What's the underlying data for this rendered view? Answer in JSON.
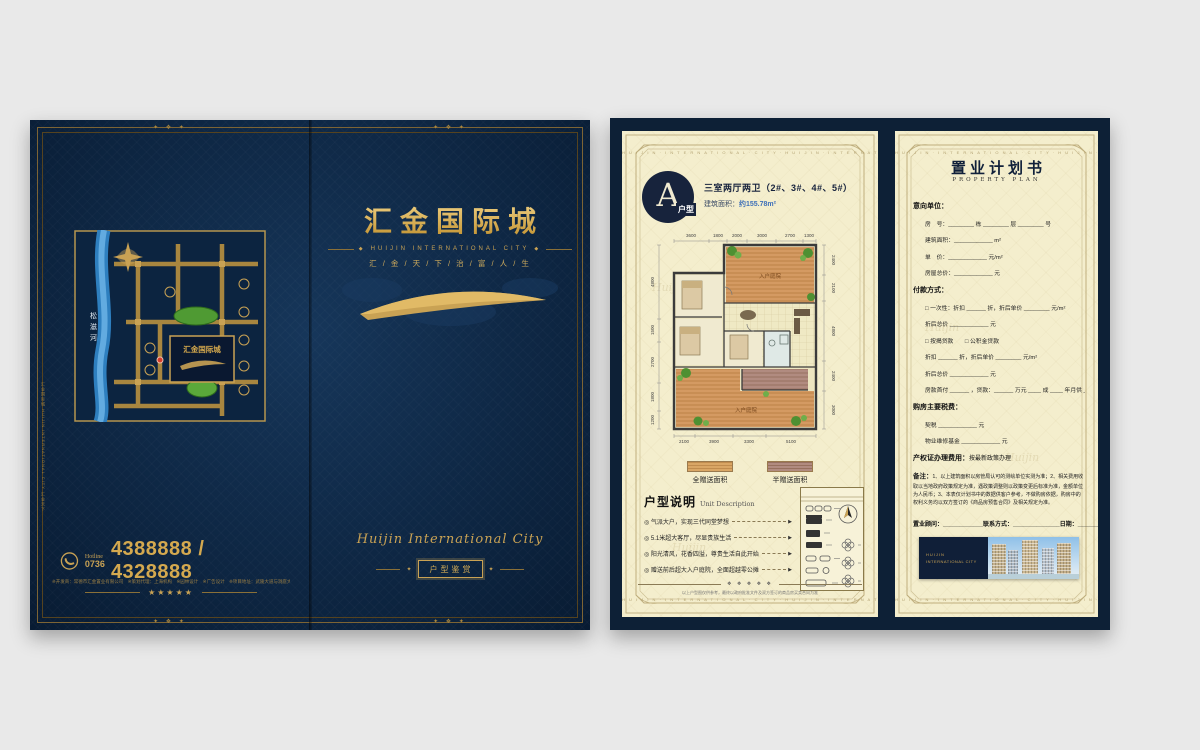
{
  "icons": {
    "diamond": "◆",
    "arrow": "▶",
    "phone": "phone-icon",
    "compass": "compass-icon"
  },
  "cover": {
    "ornament": "✦ ❖ ✦",
    "spine_text": "汇金国际城 HUIJIN INTERNATIONAL CITY 汇金天下",
    "map": {
      "river_chars": [
        "松",
        "滋",
        "河"
      ],
      "project": "汇金国际城"
    },
    "hotline_label": "Hotline",
    "hotline_code": "0736",
    "phones": "4388888 / 4328888",
    "fine_print": "※开发商：常德市汇金置业有限公司　※策划代理：上海机构　※园林设计　※广告设计　※项目地址：武陵大道与洞庭大道交汇处",
    "stars": "★★★★★",
    "title": "汇金国际城",
    "subtitle": "HUIJIN INTERNATIONAL CITY",
    "tagline": "汇 / 金 / 天 / 下 / 治 / 富 / 人 / 生",
    "script_name": "Huijin International City",
    "badge": "户型鉴赏"
  },
  "interior": {
    "border_letters": "H U I J I N · I N T E R N A T I O N A L · C I T Y · H U I J I N · I N T E R N A T I O N A L · C I T Y",
    "watermark": "Huijin",
    "unit": {
      "letter": "A",
      "type_label": "户型",
      "rooms": "三室两厅两卫（2#、3#、4#、5#）",
      "area_label": "建筑面积：",
      "area_value": "约155.78m²"
    },
    "floorplan": {
      "courtyard_top": "入户庭院",
      "courtyard_bottom": "入户庭院",
      "dims_top": [
        "3600",
        "1800",
        "2000",
        "3000",
        "2700",
        "1300"
      ],
      "dims_bottom": [
        "2100",
        "3900",
        "3300",
        "5100"
      ],
      "dims_left": [
        "4800",
        "1500",
        "2700",
        "1800",
        "1200"
      ],
      "dims_right": [
        "2400",
        "2100",
        "4800",
        "2400",
        "3000"
      ]
    },
    "legend": {
      "full": "全赠送面积",
      "half": "半赠送面积"
    },
    "unit_desc": {
      "title": "户型说明",
      "subtitle": "Unit Description",
      "items": [
        "◎ 气派大户，实现三代同堂梦想",
        "◎ 5.1米超大客厅，尽显贵族生活",
        "◎ 阳光清风，花香四溢，尊贵生活自此开始",
        "◎ 赠送前后超大入户庭院，全面超越零公摊"
      ],
      "arrow": "▶",
      "divider_glyphs": "❖ ❖ ❖ ❖ ❖",
      "disclaimer": "以上户型图仅供参考，最终以政府批准文件及双方签订的商品房买卖合同为准"
    }
  },
  "form": {
    "title": "置业计划书",
    "subtitle": "PROPERTY PLAN",
    "intent": {
      "label": "意向单位：",
      "lines": [
        "房　号：________ 栋 ________ 层 ________ 号",
        "建筑面积：____________ m²",
        "单　价：____________ 元/m²",
        "房屋总价：____________ 元"
      ]
    },
    "payment": {
      "label": "付款方式：",
      "lines": [
        "□ 一次性：折扣 ______ 折，折后单价 ________ 元/m²",
        "折后总价 ____________ 元",
        "□ 按揭贷款　　□ 公积金贷款",
        "折扣 ______ 折，折后单价 ________ 元/m²",
        "折后总价 ____________ 元",
        "房款首付 ______ ，贷款：______ 万元 ____ 成 ____ 年月供 ____ 元/月"
      ]
    },
    "taxes": {
      "label": "购房主要税费：",
      "lines": [
        "契税 ____________ 元",
        "物业维修基金 ____________ 元"
      ]
    },
    "cert": {
      "label": "产权证办理费用：",
      "value": "按最新政策办理"
    },
    "notes": {
      "label": "备注：",
      "text": "1、以上建筑面积以房管局认可的测绘单位实测为准；2、相关费用收取以当地政府政策规定为准，遇政策调整则以政策变更后标准为准，金额单位为人民币；3、本表仅计划书中的数据供客户参考，不做购房依据，购房中的权利义务均以双方签订的《商品房预售合同》及相关规定为准。"
    },
    "footer": {
      "advisor": "置业顾问：____________",
      "contact": "联系方式：______________",
      "date": "日期：________"
    },
    "logo": {
      "line1": "HUIJIN",
      "line2": "INTERNATIONAL CITY"
    }
  }
}
